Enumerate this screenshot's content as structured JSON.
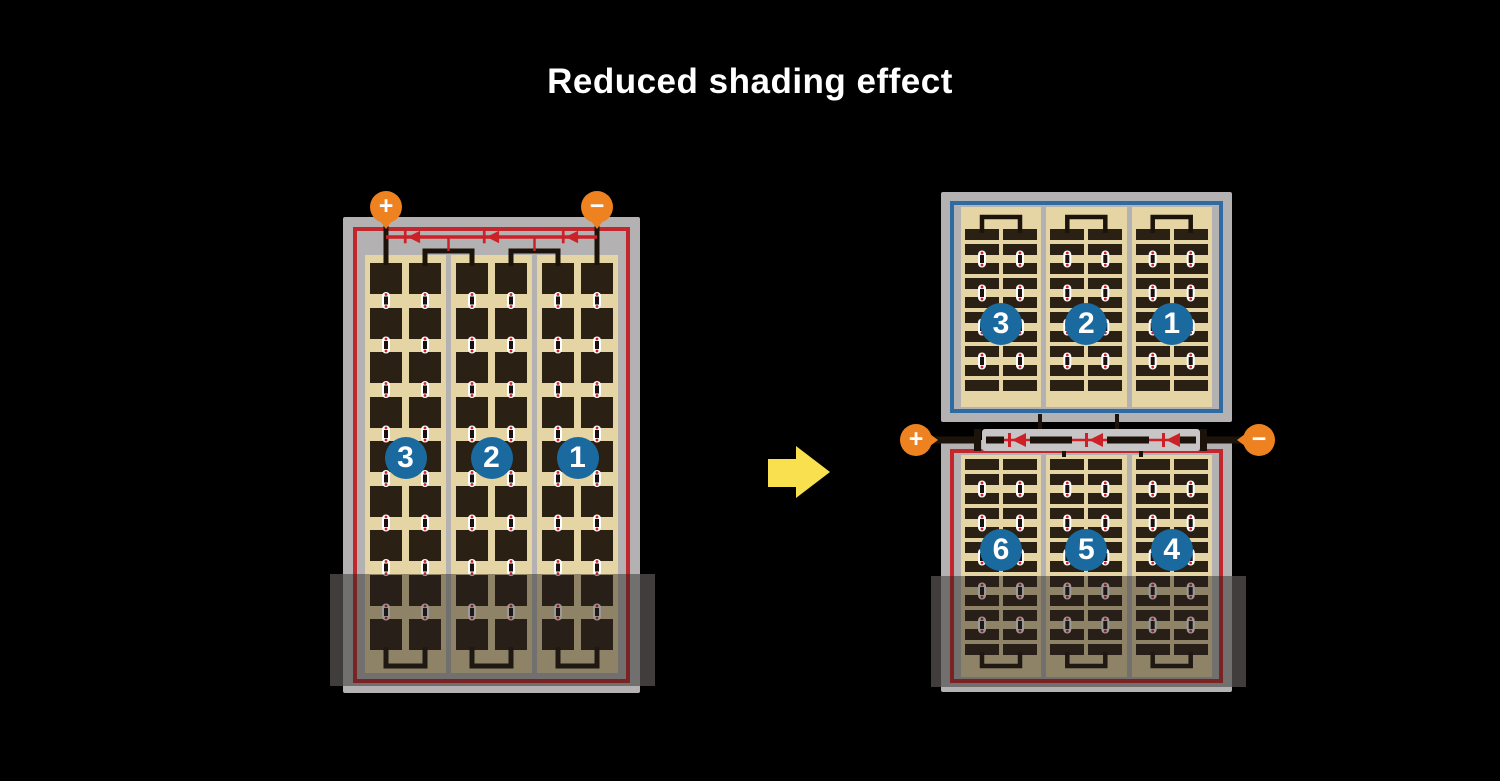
{
  "title": "Reduced shading effect",
  "colors": {
    "background": "#000000",
    "title_text": "#ffffff",
    "frame_gray": "#b3b1b2",
    "divider_gray": "#b3b1b2",
    "cell_field_tan": "#e5d5a4",
    "cell_dark": "#2b2014",
    "wire_black": "#1c130b",
    "module_red_border": "#c1272d",
    "module_blue_border": "#2e6ba3",
    "bus_red": "#cc2127",
    "badge_blue": "#1a6aa0",
    "terminal_orange": "#ee8120",
    "channel_gray": "#c7c5c6",
    "arrow_yellow": "#f9e04f",
    "shade_overlay": "rgba(35,32,28,0.45)",
    "shade_edge": "#403d3c"
  },
  "left_module": {
    "cell_type": "full",
    "strings": 3,
    "columns_per_string": 2,
    "rows": 9,
    "badges": [
      "3",
      "2",
      "1"
    ],
    "terminals": {
      "positive": "+",
      "negative": "−"
    },
    "bypass_diodes": 3
  },
  "right_top_module": {
    "cell_type": "half",
    "strings": 3,
    "columns_per_string": 2,
    "rows": 10,
    "badges": [
      "3",
      "2",
      "1"
    ]
  },
  "right_bottom_module": {
    "cell_type": "half",
    "strings": 3,
    "columns_per_string": 2,
    "rows": 12,
    "badges": [
      "6",
      "5",
      "4"
    ]
  },
  "junction": {
    "terminals": {
      "positive": "+",
      "negative": "−"
    },
    "bypass_diodes": 3
  },
  "arrow": {
    "direction": "right"
  }
}
